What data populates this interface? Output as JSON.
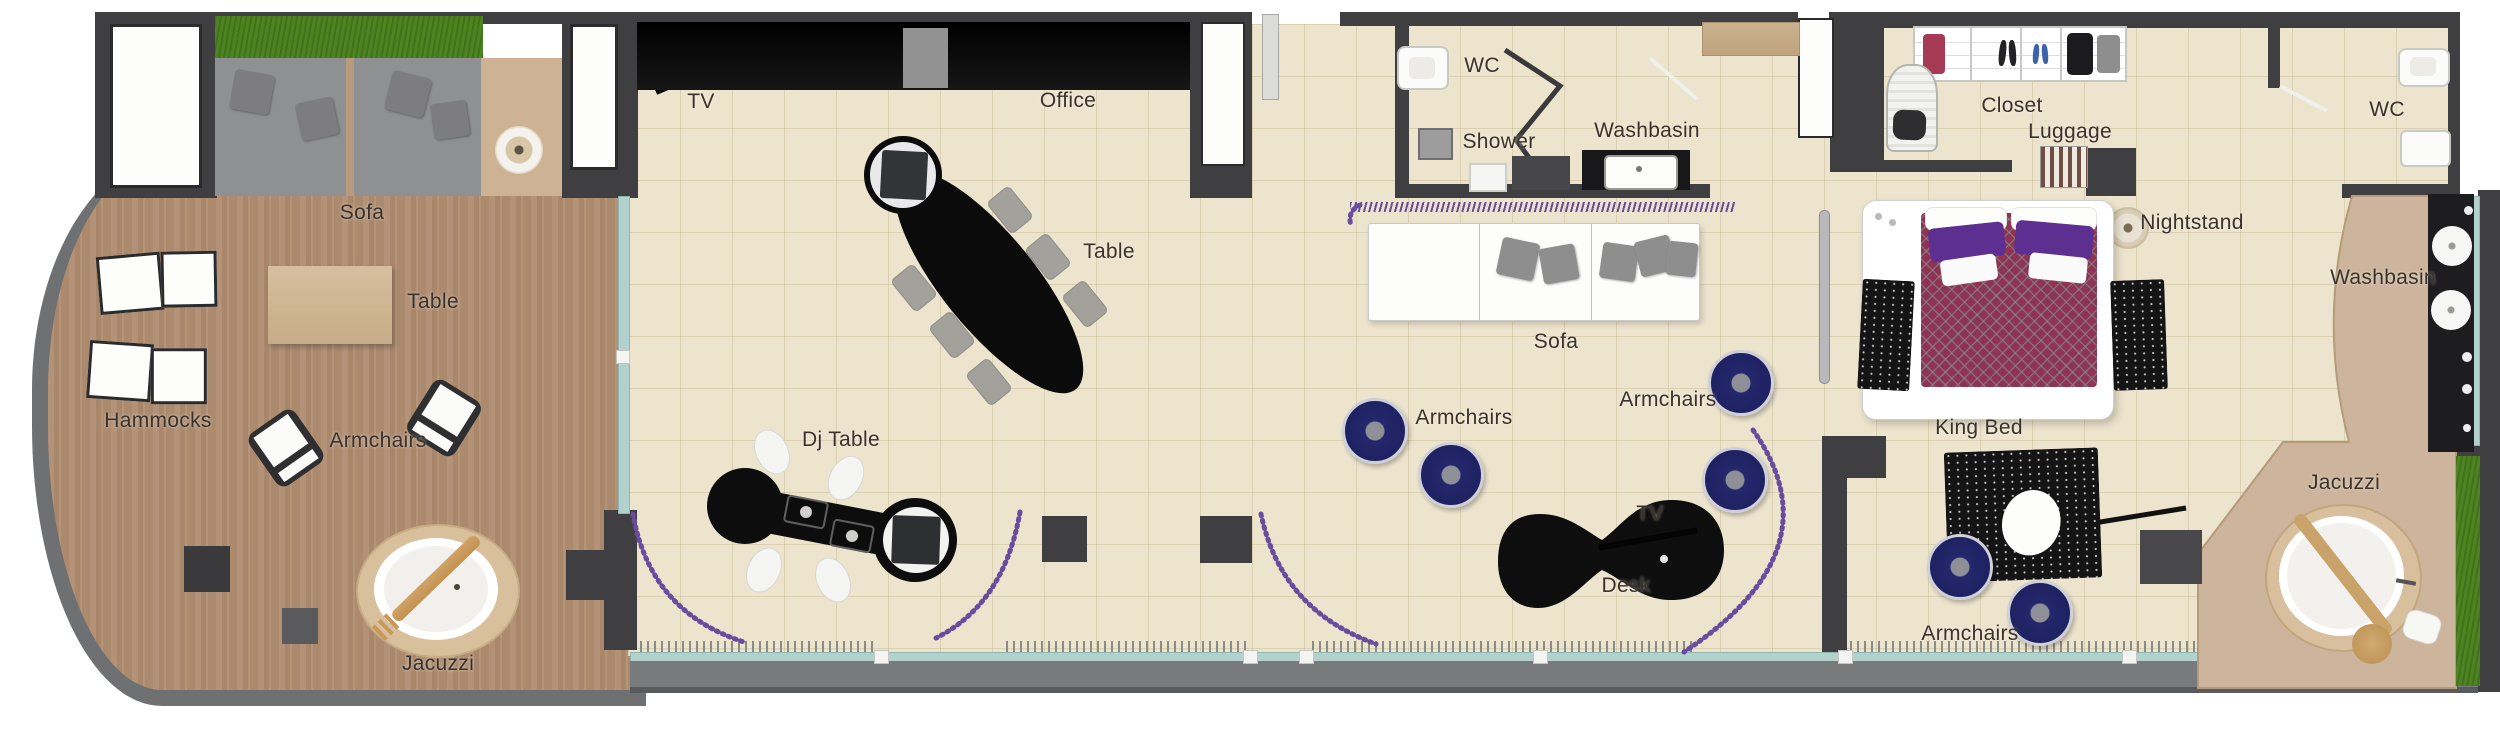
{
  "colors": {
    "wall": "#3f3f41",
    "floor_tile": "#ede4cd",
    "terrace_wood": "#b19078",
    "path_wood": "#cdb49c",
    "grass": "#4c8420",
    "glass": "#b3d2cd",
    "curtain": "#6a4c9f",
    "armchair_navy": "#23276b",
    "bed_duvet": "#8e3352",
    "pillow_purple": "#5c2f90",
    "label_text": "#3a322b"
  },
  "areas": {
    "terrace": {
      "labels": {
        "sofa": "Sofa",
        "table": "Table",
        "hammocks": "Hammocks",
        "armchairs": "Armchairs",
        "jacuzzi": "Jacuzzi"
      }
    },
    "office_lounge": {
      "labels": {
        "tv": "TV",
        "office": "Office",
        "table": "Table",
        "dj_table": "Dj Table"
      }
    },
    "bathroom": {
      "labels": {
        "wc": "WC",
        "shower": "Shower",
        "washbasin": "Washbasin"
      }
    },
    "living_room": {
      "labels": {
        "sofa": "Sofa",
        "armchairs_left": "Armchairs",
        "armchairs_right": "Armchairs",
        "tv": "TV",
        "desk": "Desk"
      }
    },
    "bedroom": {
      "labels": {
        "closet": "Closet",
        "luggage": "Luggage",
        "wc": "WC",
        "nightstand": "Nightstand",
        "washbasin": "Washbasin",
        "king_bed": "King Bed",
        "armchairs": "Armchairs",
        "jacuzzi": "Jacuzzi"
      }
    }
  }
}
